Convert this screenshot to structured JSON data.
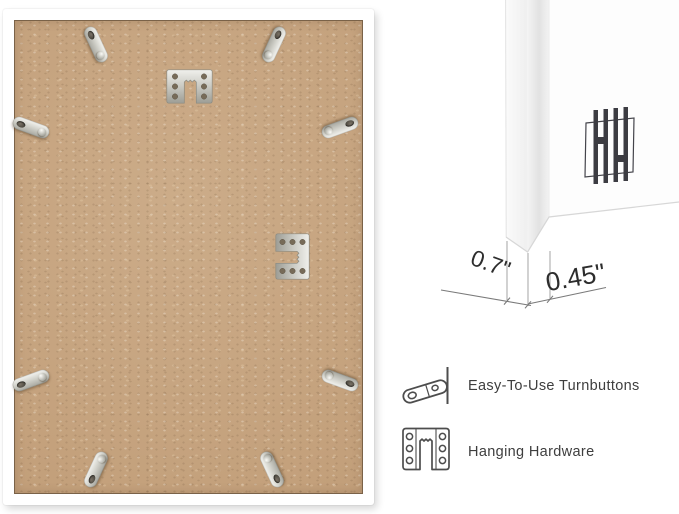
{
  "product_image": {
    "description": "back view of white picture frame with MDF board",
    "frame_back": {
      "board_material_color": "#c6a480",
      "frame_color": "#ffffff",
      "turnbutton_count": 8,
      "hanger_count": 2
    },
    "corner_detail": {
      "depth_dimension": "0.7\"",
      "face_dimension": "0.45\"",
      "brand_mark": "HH"
    },
    "features": [
      {
        "icon": "turnbutton-icon",
        "label": "Easy-To-Use Turnbuttons"
      },
      {
        "icon": "hanging-hardware-icon",
        "label": "Hanging Hardware"
      }
    ],
    "colors": {
      "metal": "#d3d3cc",
      "outline_gray": "#4d4d4d",
      "text_gray": "#3e3e3e",
      "dimension_line": "#7a7a7a"
    }
  }
}
